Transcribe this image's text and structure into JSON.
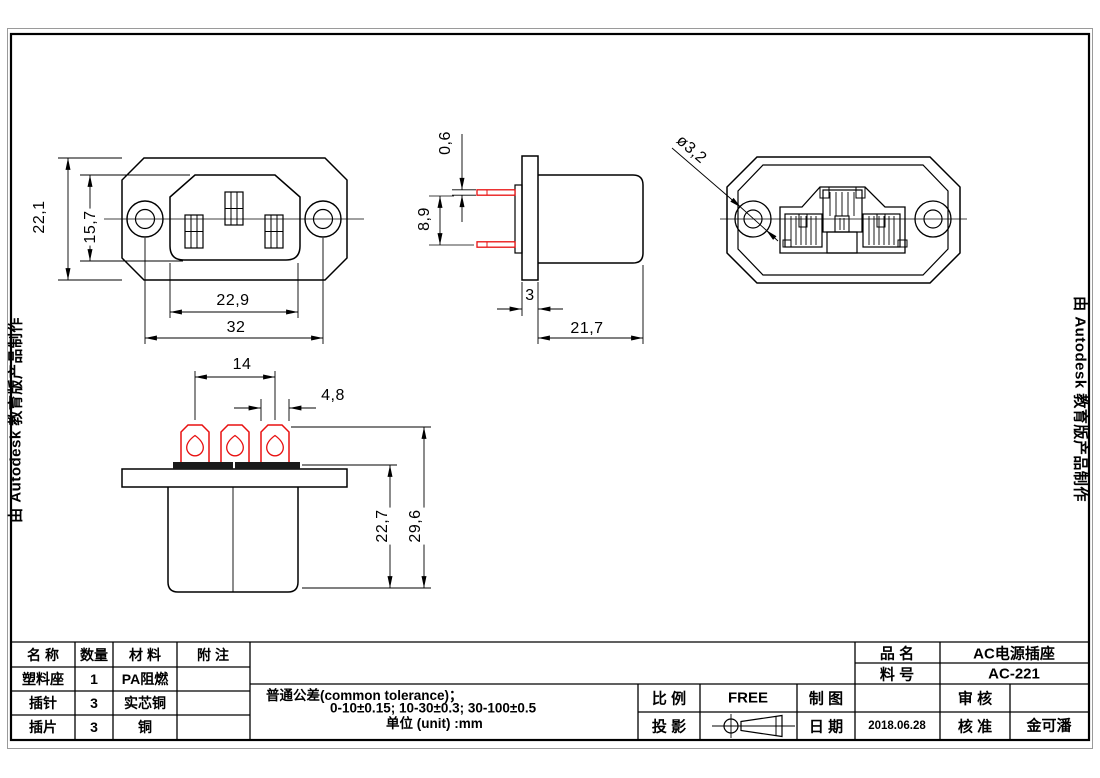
{
  "watermark": {
    "text": "由 Autodesk 教育版产品制作"
  },
  "views": {
    "front": {
      "dims": {
        "height": "22,1",
        "socket_height": "15,7",
        "socket_width": "22,9",
        "hole_spacing": "32"
      }
    },
    "side": {
      "dims": {
        "pin_thickness": "0,6",
        "pin_spacing": "8,9",
        "flange_thickness": "3",
        "body_depth": "21,7"
      }
    },
    "rear": {
      "dims": {
        "hole_diameter": "ø3,2"
      }
    },
    "bottom": {
      "dims": {
        "terminal_spacing": "14",
        "terminal_width": "4,8",
        "body_height": "22,7",
        "total_height": "29,6"
      }
    }
  },
  "title_block": {
    "bom": {
      "headers": [
        "名 称",
        "数量",
        "材 料",
        "附 注"
      ],
      "rows": [
        {
          "name": "塑料座",
          "qty": "1",
          "material": "PA阻燃",
          "note": ""
        },
        {
          "name": "插针",
          "qty": "3",
          "material": "实芯铜",
          "note": ""
        },
        {
          "name": "插片",
          "qty": "3",
          "material": "铜",
          "note": ""
        }
      ]
    },
    "tolerance": {
      "line1": "普通公差(common tolerance)；",
      "line2": "0-10±0.15; 10-30±0.3; 30-100±0.5",
      "line3": "单位 (unit) :mm"
    },
    "fields": {
      "scale_label": "比 例",
      "scale_value": "FREE",
      "projection_label": "投 影",
      "drawn_label": "制 图",
      "drawn_value": "",
      "date_label": "日 期",
      "date_value": "2018.06.28",
      "product_label": "品 名",
      "product_value": "AC电源插座",
      "part_no_label": "料 号",
      "part_no_value": "AC-221",
      "review_label": "审 核",
      "review_value": "",
      "approve_label": "核 准",
      "approve_value": "金可潘"
    }
  },
  "colors": {
    "line": "#000000",
    "accent_red": "#e81010",
    "frame_gray": "#9a9a9a"
  }
}
